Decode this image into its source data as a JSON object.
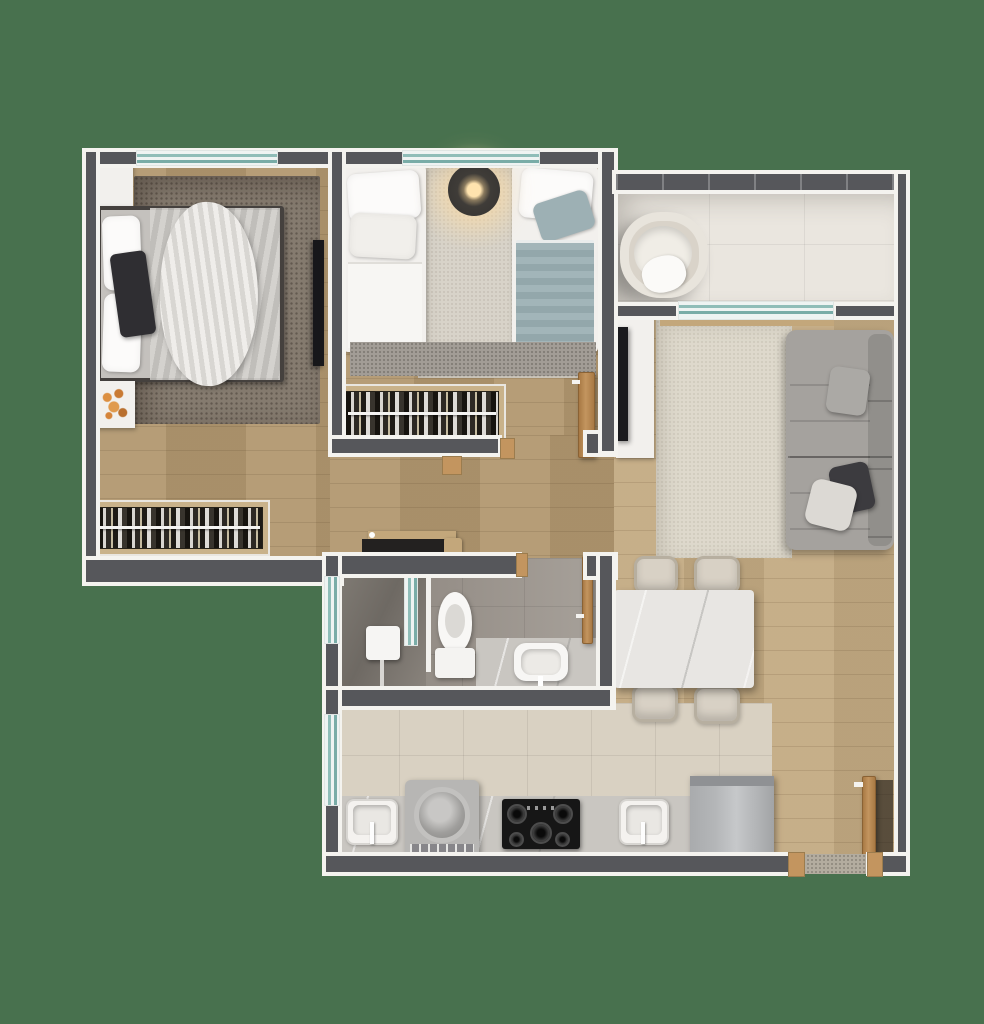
{
  "scene": {
    "description": "3D rendered top-down floor plan of a small apartment on a plain green background",
    "view": "top-down orthographic render",
    "background_color": "#48714E"
  },
  "palette": {
    "bg": "#48714E",
    "wall": "#56575B",
    "trim": "#F4F3EF",
    "wood": "#B1976F",
    "wood-light": "#C3AA82",
    "tile-kitchen": "#D9D1C2",
    "tile-balcony": "#EAE6DF",
    "bath-floor": "#968F88",
    "glass": "#8FBDB8",
    "door-wood": "#C3955F",
    "rug-master": "#857B6F",
    "rug-light": "#D8D3C9",
    "rug-living": "#DED9CC",
    "sofa": "#A5A29E",
    "furn-white": "#F2F0ED",
    "marble": "#C9C6C1",
    "appliance-dark": "#161616",
    "steel": "#B4B6B8",
    "accent-flowers": "#D5843A",
    "teal-bedding": "#A2B5B9"
  },
  "rooms": [
    {
      "label": "Master Bedroom",
      "furniture": [
        "double bed",
        "bedside cabinet",
        "flower side table",
        "grey rug",
        "wall TV",
        "open wardrobe",
        "window"
      ]
    },
    {
      "label": "Second Bedroom",
      "furniture": [
        "twin bed white",
        "twin bed teal",
        "pendant lamp",
        "light rug",
        "open wardrobe",
        "door",
        "window"
      ]
    },
    {
      "label": "Balcony",
      "furniture": [
        "round armchair",
        "glass railing",
        "sliding glass door"
      ]
    },
    {
      "label": "Living Room",
      "furniture": [
        "grey sofa with cushions",
        "area rug",
        "wall TV",
        "media console"
      ]
    },
    {
      "label": "Dining Area",
      "furniture": [
        "stone dining table",
        "four chairs"
      ]
    },
    {
      "label": "Bathroom",
      "furniture": [
        "shower",
        "glass partition",
        "toilet",
        "vanity with sink",
        "door",
        "frosted window"
      ]
    },
    {
      "label": "Kitchen",
      "furniture": [
        "laundry sink",
        "washing machine",
        "gas cooktop",
        "kitchen sink",
        "refrigerator",
        "stone counter",
        "frosted window"
      ]
    },
    {
      "label": "Hallway",
      "furniture": [
        "low console"
      ]
    },
    {
      "label": "Entry",
      "furniture": [
        "entrance door",
        "threshold"
      ]
    }
  ]
}
